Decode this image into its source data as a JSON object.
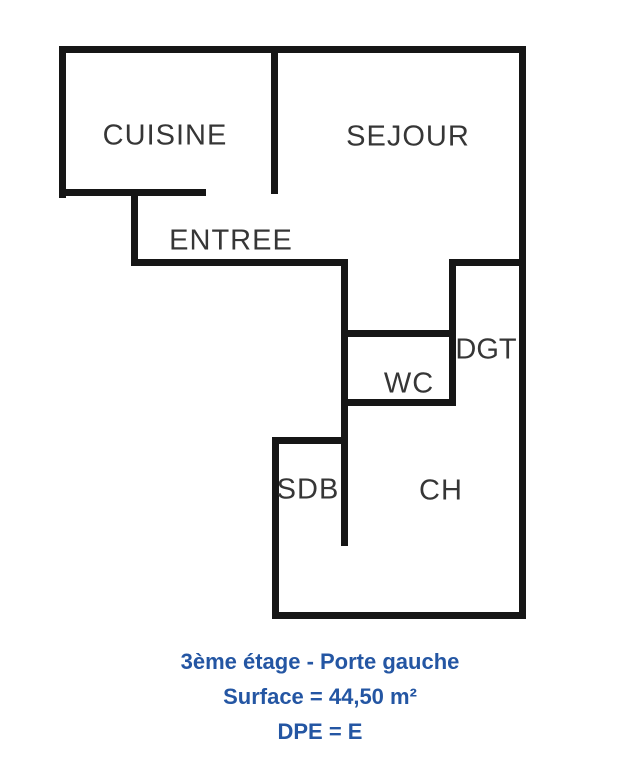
{
  "plan": {
    "title": "floor-plan",
    "wall_color": "#161616",
    "label_color": "#363636",
    "caption_color": "#2456a3",
    "background": "#ffffff"
  },
  "rooms": [
    {
      "id": "cuisine",
      "label": "CUISINE"
    },
    {
      "id": "sejour",
      "label": "SEJOUR"
    },
    {
      "id": "entree",
      "label": "ENTREE"
    },
    {
      "id": "dgt",
      "label": "DGT"
    },
    {
      "id": "wc",
      "label": "WC"
    },
    {
      "id": "sdb",
      "label": "SDB"
    },
    {
      "id": "ch",
      "label": "CH"
    }
  ],
  "caption": {
    "line1": "3ème étage - Porte gauche",
    "line2": "Surface = 44,50 m²",
    "line3": "DPE = E"
  }
}
